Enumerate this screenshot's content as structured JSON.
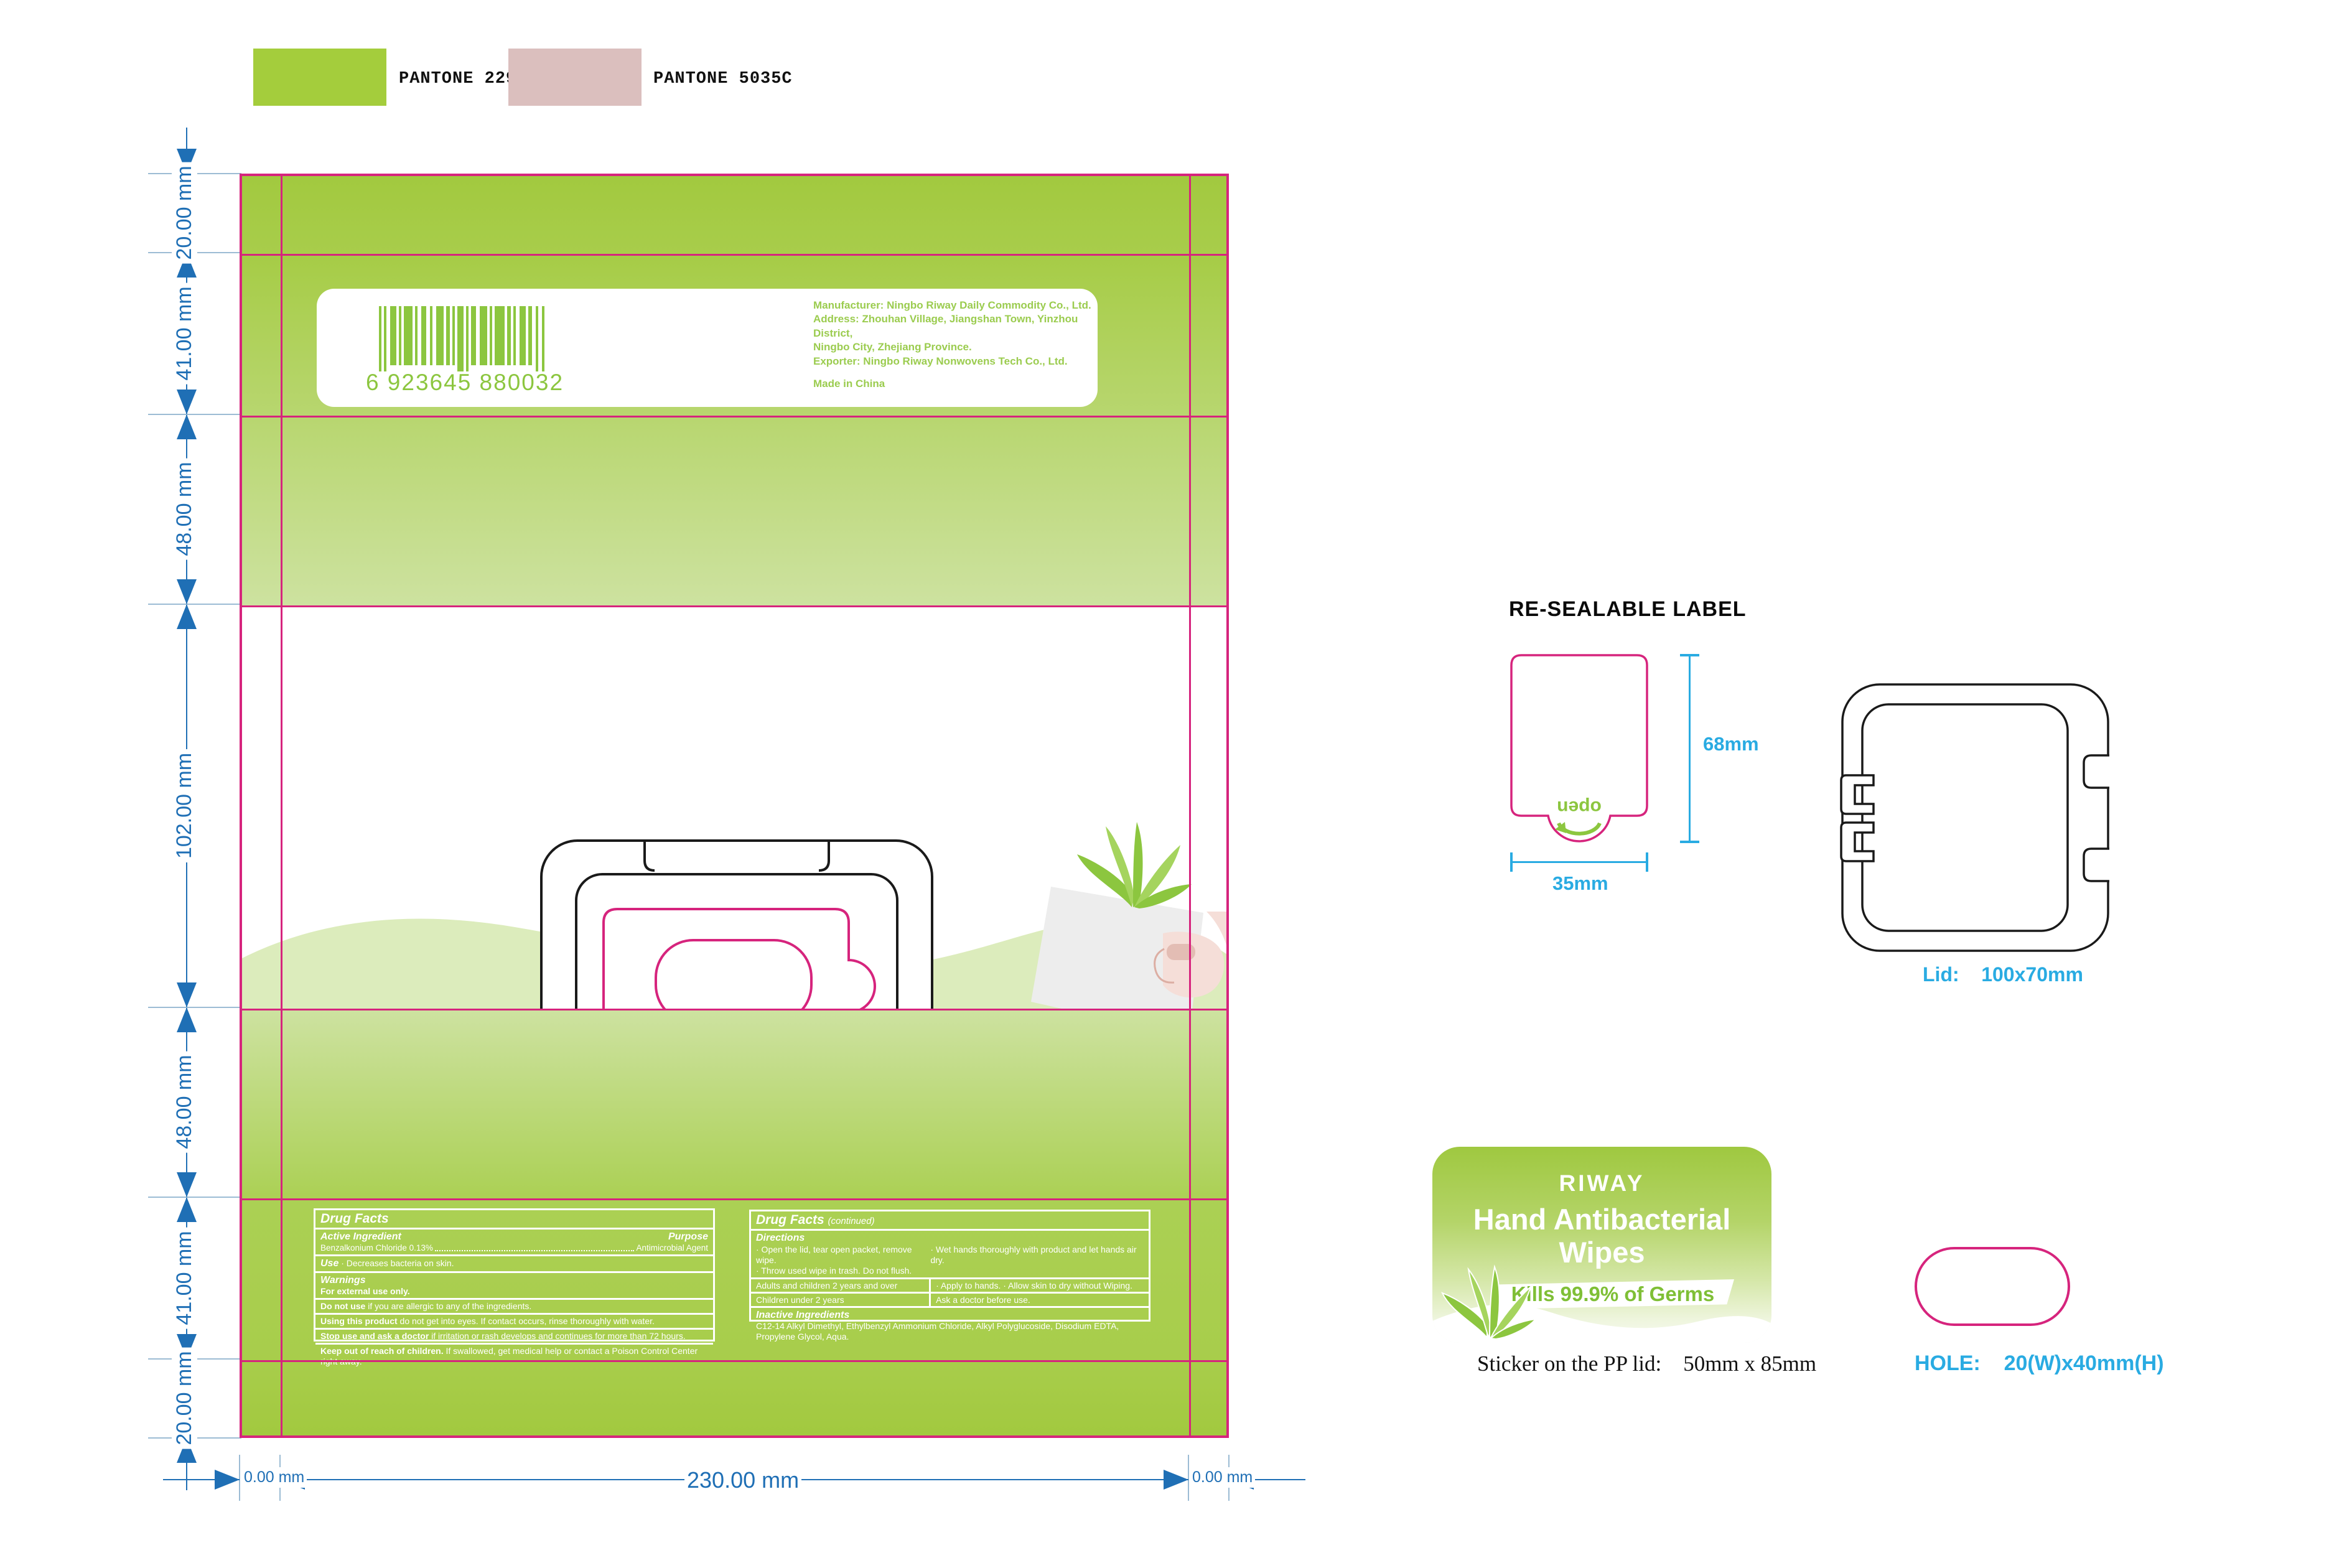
{
  "swatches": [
    {
      "label": "PANTONE 2299C",
      "color": "#a4cd3c"
    },
    {
      "label": "PANTONE 5035C",
      "color": "#dbbfbe"
    }
  ],
  "colors": {
    "dieline_pink": "#d6247d",
    "brand_green": "#8cc63f",
    "dim_blue": "#1f6fb5",
    "spec_cyan": "#29abe2"
  },
  "dieline_dims": {
    "left_labels": [
      "20.00 mm",
      "41.00 mm",
      "48.00 mm",
      "102.00 mm",
      "48.00 mm",
      "41.00 mm",
      "20.00 mm"
    ],
    "bottom_left": "0.00 mm",
    "bottom_center": "230.00 mm",
    "bottom_right": "0.00 mm"
  },
  "package": {
    "barcode_number": "6 923645 880032",
    "manufacturer": {
      "lines": [
        "Manufacturer: Ningbo Riway Daily Commodity Co., Ltd.",
        "Address: Zhouhan Village, Jiangshan Town, Yinzhou District,",
        "Ningbo City, Zhejiang Province.",
        "Exporter: Ningbo Riway Nonwovens Tech Co., Ltd."
      ],
      "made_in": "Made in China"
    },
    "bullets": [
      "Super Soft Nonwoven",
      "Free Hand Washing",
      "Anti-bacterial"
    ],
    "count": "80",
    "count_unit": "Wipes",
    "wipe_size": "15x20cm",
    "drug_facts": {
      "title": "Drug Facts",
      "active_ingredient_label": "Active Ingredient",
      "purpose_label": "Purpose",
      "active_ingredient_value": "Benzalkonium Chloride 0.13%",
      "purpose_value": "Antimicrobial Agent",
      "use_label": "Use",
      "use_text": "· Decreases bacteria on skin.",
      "warnings_label": "Warnings",
      "warnings_text": "For external use only.",
      "rows": [
        {
          "lead": "Do not use",
          "text": " if you are allergic to any of the ingredients."
        },
        {
          "lead": "Using this product",
          "text": " do not get into eyes. If contact occurs, rinse thoroughly with water."
        },
        {
          "lead": "Stop use and ask a doctor",
          "text": " if irritation or rash develops and continues for more than 72 hours."
        },
        {
          "lead": "Keep out of reach of children.",
          "text": " If swallowed, get medical help or contact a Poison Control Center right away."
        }
      ]
    },
    "drug_facts_continued": {
      "title": "Drug Facts",
      "continued_label": "(continued)",
      "directions_label": "Directions",
      "directions_col1_line1": "· Open the lid, tear open packet, remove wipe.",
      "directions_col1_line2": "· Throw used wipe in trash. Do not flush.",
      "directions_col2": "· Wet hands thoroughly with product and let hands air dry.",
      "table": [
        {
          "left": "Adults and children 2 years and over",
          "right": "· Apply to hands.  · Allow skin to dry without Wiping."
        },
        {
          "left": "Children under 2 years",
          "right": "Ask a doctor before use."
        }
      ],
      "inactive_label": "Inactive Ingredients",
      "inactive_text": "C12-14 Alkyl Dimethyl, Ethylbenzyl Ammonium Chloride, Alkyl Polyglucoside, Disodium EDTA, Propylene Glycol, Aqua."
    }
  },
  "resealable_label": {
    "title": "RE-SEALABLE LABEL",
    "open_label": "open",
    "height_dim": "68mm",
    "width_dim": "35mm"
  },
  "lid": {
    "caption_label": "Lid:",
    "caption_value": "100x70mm"
  },
  "sticker": {
    "brand": "RIWAY",
    "title_line1": "Hand Antibacterial",
    "title_line2": "Wipes",
    "banner": "Kills 99.9% of Germs",
    "caption_label": "Sticker on the PP lid:",
    "caption_value": "50mm x 85mm"
  },
  "hole": {
    "caption_label": "HOLE:",
    "caption_value": "20(W)x40mm(H)"
  }
}
